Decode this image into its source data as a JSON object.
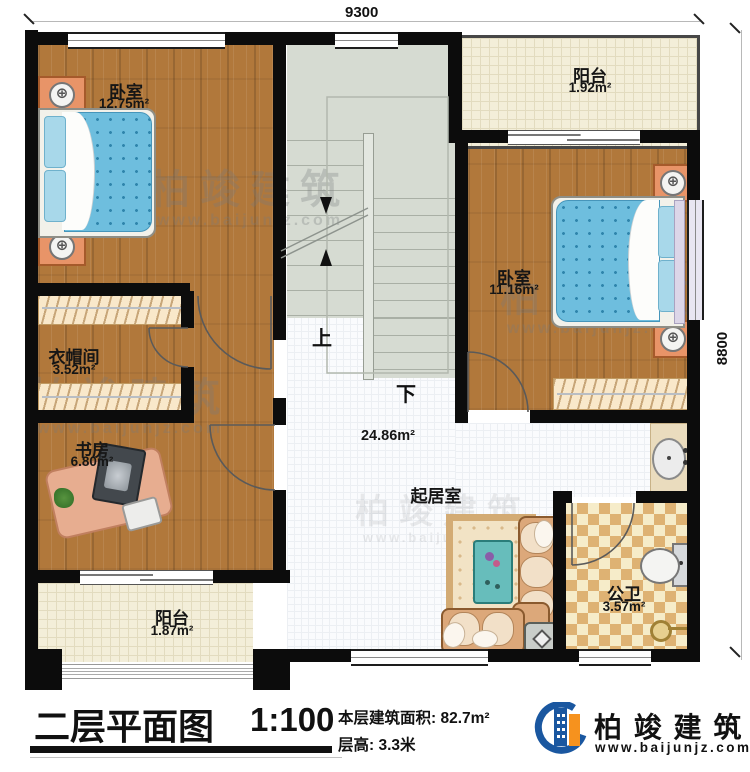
{
  "dimensions": {
    "top": "9300",
    "right": "8800"
  },
  "rooms": {
    "bedroom_top_left": {
      "name": "卧室",
      "area": "12.75m²"
    },
    "balcony_top": {
      "name": "阳台",
      "area": "1.92m²"
    },
    "bedroom_right": {
      "name": "卧室",
      "area": "11.16m²"
    },
    "cloakroom": {
      "name": "衣帽间",
      "area": "3.52m²"
    },
    "study": {
      "name": "书房",
      "area": "6.80m²"
    },
    "balcony_bottom": {
      "name": "阳台",
      "area": "1.87m²"
    },
    "living": {
      "name": "起居室",
      "area": "24.86m²"
    },
    "bathroom": {
      "name": "公卫",
      "area": "3.57m²"
    }
  },
  "stairs": {
    "up": "上",
    "down": "下"
  },
  "titlebar": {
    "title": "二层平面图",
    "scale": "1:100",
    "floor_area": "本层建筑面积: 82.7m²",
    "floor_height": "层高: 3.3米"
  },
  "brand": {
    "name": "柏 竣 建 筑",
    "website": "www.baijunjz.com"
  },
  "watermark": {
    "name": "柏竣建筑",
    "website": "www.baijunjz.com"
  },
  "icons": {
    "lamp": "⊕"
  },
  "colors": {
    "wall": "#0c0c0c",
    "wood": "#b1783b",
    "living_tile": "#fafbfd",
    "balcony_tile": "#f3eed9",
    "stairs": "#d6dbd2",
    "checker_dark": "#deb273",
    "checker_light": "#f6ecc9",
    "brand_blue": "#1a57a0",
    "brand_orange": "#f6921e"
  }
}
